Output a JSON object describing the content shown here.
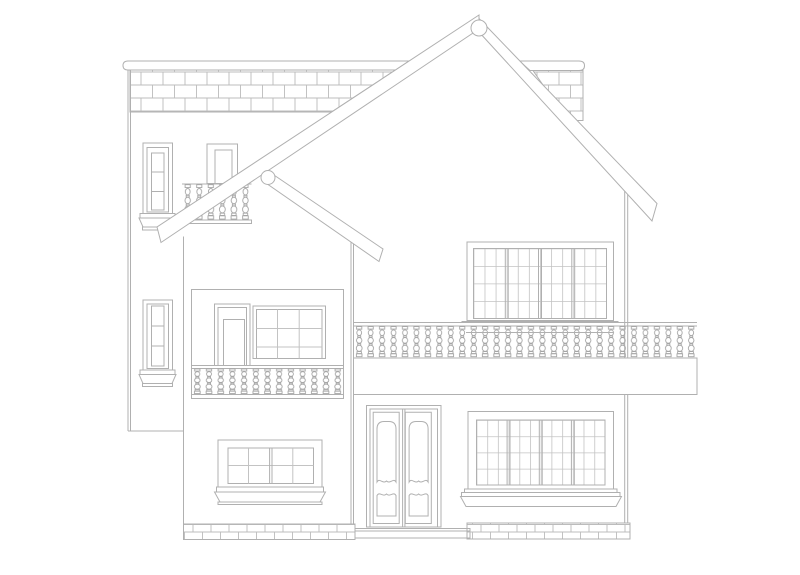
{
  "canvas": {
    "width": 800,
    "height": 575,
    "background_color": "#ffffff"
  },
  "style": {
    "line_color": "#b0b0b0",
    "detail_line_color": "#a6a6a6",
    "grid_line_color": "#c3c3c3",
    "brick_line_color": "#bcbcbc",
    "fill_color": "#ffffff"
  },
  "drawing": {
    "subject": "two-story house front elevation line drawing",
    "roof": {
      "apex_joints": 2,
      "rafter_beams": 3,
      "left_slope_direction": "down-left",
      "right_slope_direction": "down-right"
    },
    "rear_block": {
      "cornice_segments": 2,
      "brick_frieze_rows": 3,
      "tall_side_windows": 2,
      "window_panes_each": 3,
      "balcony_doors": 1,
      "balcony_balusters": 6
    },
    "left_wing": {
      "upper_group": {
        "balcony_door": 1,
        "window_grid": "3x3"
      },
      "balustrade_balusters": 13,
      "lower_window_grid": "4x2",
      "plinth_brick_rows": 2
    },
    "main_block": {
      "upper_window_grid": "12x4",
      "upper_window_sashes": 4,
      "balcony_balusters": 30,
      "door_leaves": 2,
      "door_panels_per_leaf": 2,
      "lower_window_grid": "12x4",
      "plinth_brick_rows": 2
    }
  }
}
